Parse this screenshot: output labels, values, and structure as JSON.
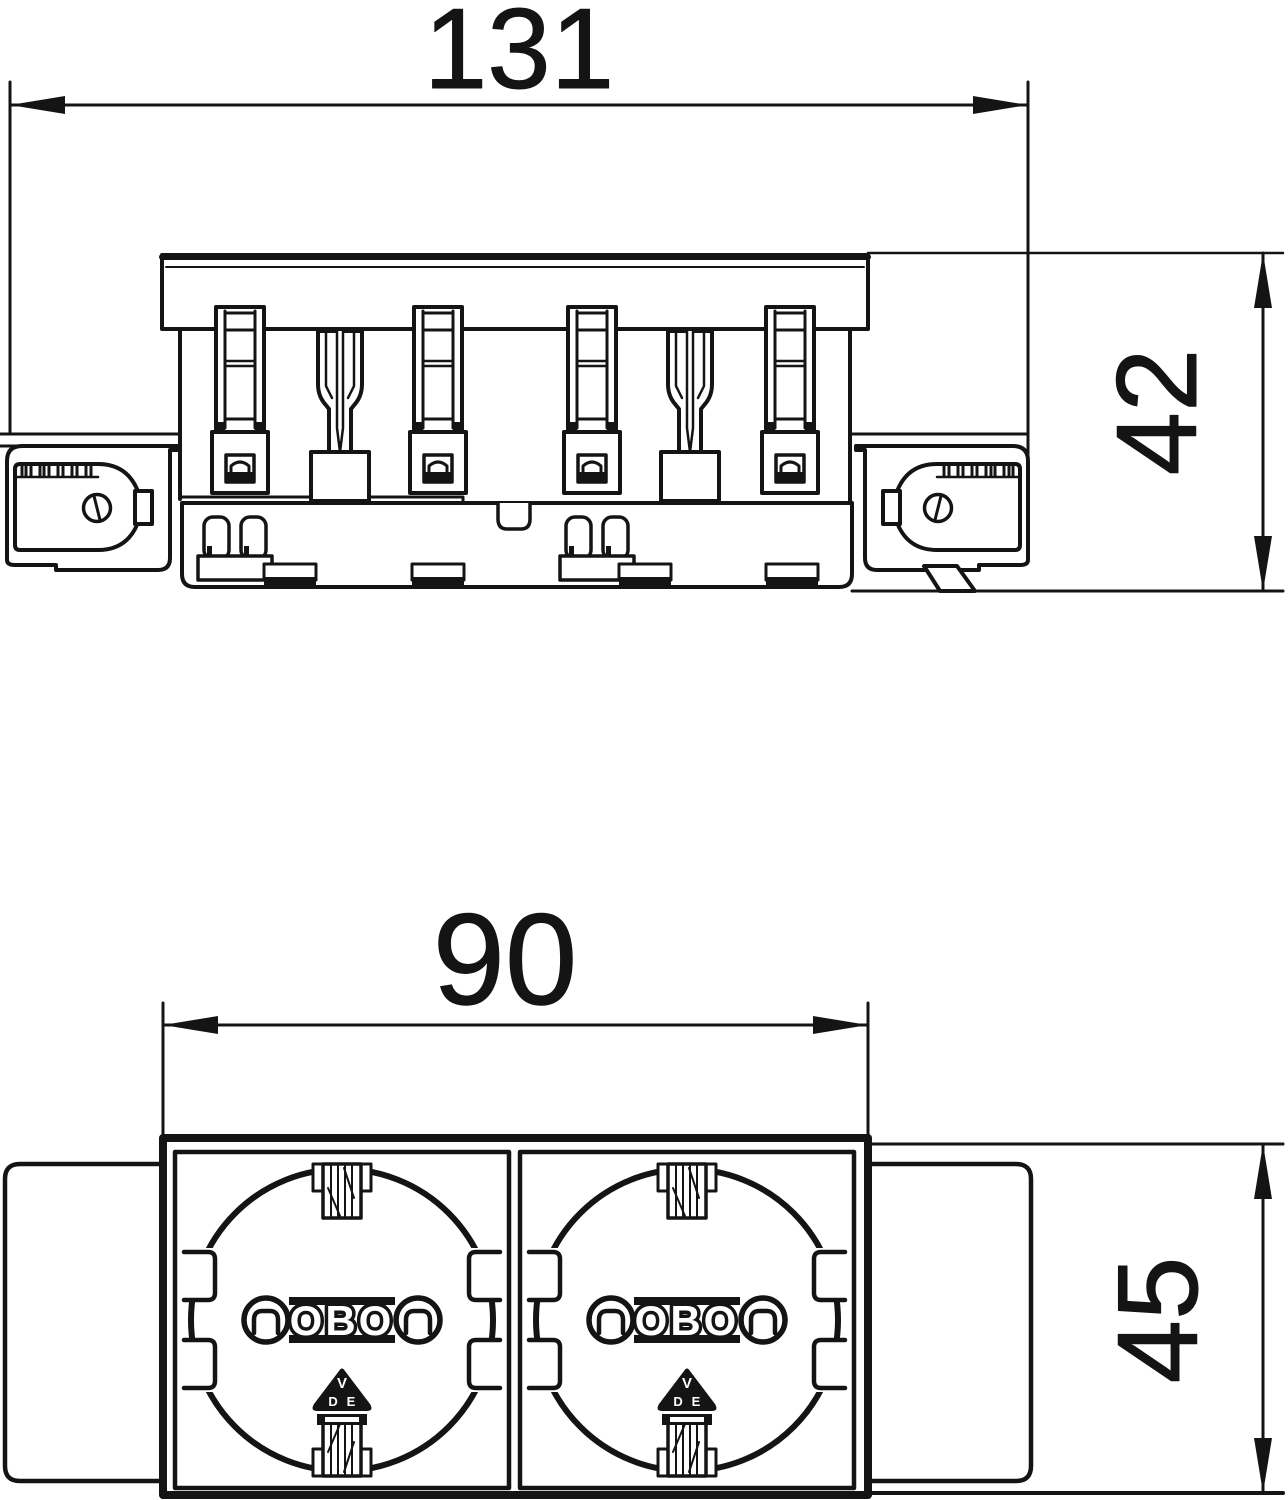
{
  "drawing": {
    "background": "#ffffff",
    "line_color": "#141414",
    "views": {
      "side": {
        "dims": {
          "width": "131",
          "height": "42"
        }
      },
      "front": {
        "dims": {
          "width": "90",
          "height": "45"
        },
        "sockets": [
          {
            "brand": "OBO",
            "mark_top": "V",
            "mark_left": "D",
            "mark_right": "E"
          },
          {
            "brand": "OBO",
            "mark_top": "V",
            "mark_left": "D",
            "mark_right": "E"
          }
        ]
      }
    }
  }
}
